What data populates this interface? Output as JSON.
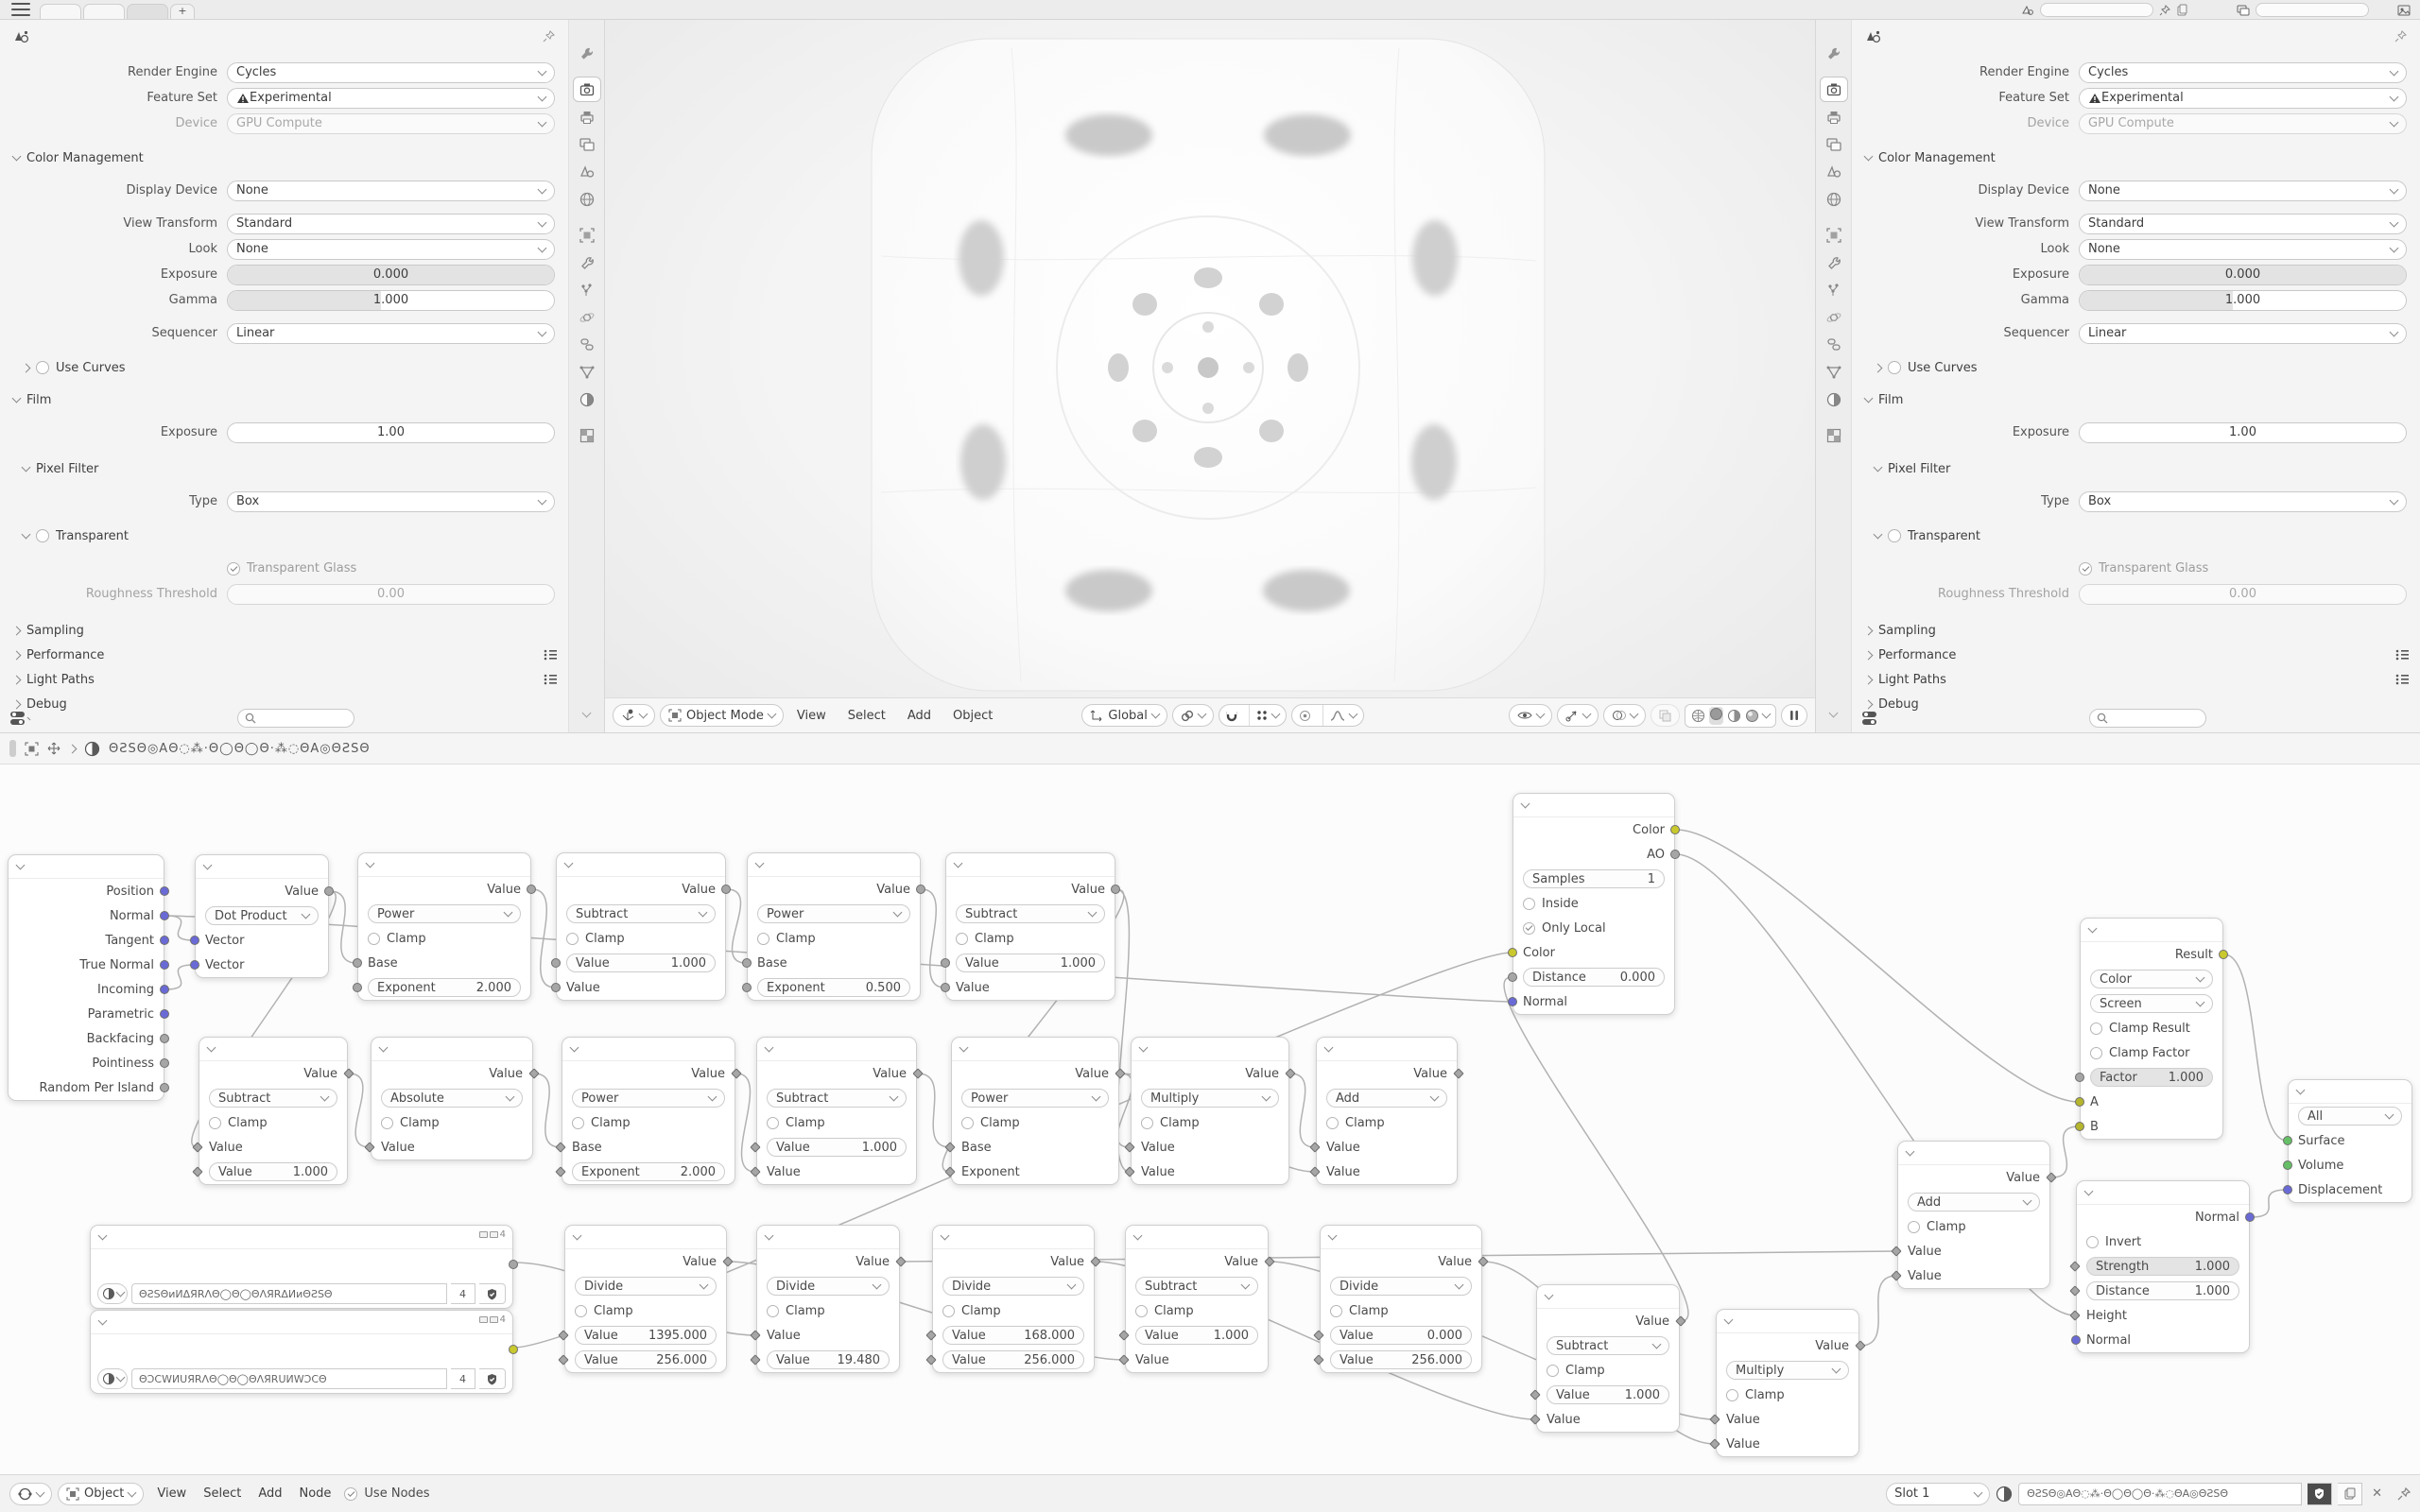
{
  "ui": {
    "topbar": {
      "new_tab": "+",
      "tab_count": 3
    },
    "prop_tabs": [
      "tool",
      "render",
      "output",
      "view-layer",
      "scene",
      "world",
      "object",
      "modifiers",
      "particles",
      "physics",
      "constraints",
      "data",
      "material",
      "texture"
    ],
    "active_tab": "render"
  },
  "props": {
    "render_engine": {
      "label": "Render Engine",
      "value": "Cycles"
    },
    "feature_set": {
      "label": "Feature Set",
      "value": "Experimental"
    },
    "device": {
      "label": "Device",
      "value": "GPU Compute"
    },
    "cm_title": "Color Management",
    "display_device": {
      "label": "Display Device",
      "value": "None"
    },
    "view_transform": {
      "label": "View Transform",
      "value": "Standard"
    },
    "look": {
      "label": "Look",
      "value": "None"
    },
    "exposure": {
      "label": "Exposure",
      "value": "0.000"
    },
    "gamma": {
      "label": "Gamma",
      "value": "1.000"
    },
    "sequencer": {
      "label": "Sequencer",
      "value": "Linear"
    },
    "use_curves": "Use Curves",
    "film_title": "Film",
    "film_exposure": {
      "label": "Exposure",
      "value": "1.00"
    },
    "pixel_filter_title": "Pixel Filter",
    "pf_type": {
      "label": "Type",
      "value": "Box"
    },
    "transparent_title": "Transparent",
    "transparent_glass": "Transparent Glass",
    "roughness": {
      "label": "Roughness Threshold",
      "value": "0.00"
    },
    "sampling": "Sampling",
    "performance": "Performance",
    "light_paths": "Light Paths",
    "debug": "Debug"
  },
  "viewport": {
    "mode": "Object Mode",
    "menus": [
      "View",
      "Select",
      "Add",
      "Object"
    ],
    "orientation": "Global"
  },
  "node_editor": {
    "material_name": "ΘƧSΘ◎AΘ◌⁂·Θ◯Θ◯Θ·⁂◌ΘA◎ΘƧSΘ",
    "footer": {
      "object": "Object",
      "menus": [
        "View",
        "Select",
        "Add",
        "Node"
      ],
      "use_nodes": "Use Nodes",
      "slot": "Slot 1",
      "material": "ΘƧSΘ◎AΘ◌⁂·Θ◯Θ◯Θ·⁂◌ΘA◎ΘƧSΘ"
    },
    "socket_colors": {
      "vec": "#6a6ad6",
      "gray": "#a6a6a6",
      "grayd": "#a6a6a6",
      "yellow": "#c9c92e",
      "olive": "#b5b52e",
      "green": "#66bf66"
    },
    "nodes": {
      "geometry": {
        "rows": [
          [
            "out",
            "Position",
            "vec"
          ],
          [
            "out",
            "Normal",
            "vec"
          ],
          [
            "out",
            "Tangent",
            "vec"
          ],
          [
            "out",
            "True Normal",
            "vec"
          ],
          [
            "out",
            "Incoming",
            "vec"
          ],
          [
            "out",
            "Parametric",
            "vec"
          ],
          [
            "out",
            "Backfacing",
            "gray"
          ],
          [
            "out",
            "Pointiness",
            "gray"
          ],
          [
            "out",
            "Random Per Island",
            "gray"
          ]
        ]
      },
      "dot": {
        "rows": [
          [
            "out",
            "Value",
            "gray"
          ],
          [
            "select",
            "Dot Product"
          ],
          [
            "in",
            "Vector",
            "vec"
          ],
          [
            "in",
            "Vector",
            "vec"
          ]
        ]
      },
      "pow1": {
        "rows": [
          [
            "out",
            "Value",
            "gray"
          ],
          [
            "select",
            "Power"
          ],
          [
            "check",
            "Clamp",
            0
          ],
          [
            "in",
            "Base",
            "gray"
          ],
          [
            "field",
            "Exponent",
            "2.000",
            "gray"
          ]
        ]
      },
      "sub1": {
        "rows": [
          [
            "out",
            "Value",
            "gray"
          ],
          [
            "select",
            "Subtract"
          ],
          [
            "check",
            "Clamp",
            0
          ],
          [
            "field",
            "Value",
            "1.000",
            "gray"
          ],
          [
            "in",
            "Value",
            "gray"
          ]
        ]
      },
      "pow2": {
        "rows": [
          [
            "out",
            "Value",
            "gray"
          ],
          [
            "select",
            "Power"
          ],
          [
            "check",
            "Clamp",
            0
          ],
          [
            "in",
            "Base",
            "gray"
          ],
          [
            "field",
            "Exponent",
            "0.500",
            "gray"
          ]
        ]
      },
      "sub2": {
        "rows": [
          [
            "out",
            "Value",
            "gray"
          ],
          [
            "select",
            "Subtract"
          ],
          [
            "check",
            "Clamp",
            0
          ],
          [
            "field",
            "Value",
            "1.000",
            "gray"
          ],
          [
            "in",
            "Value",
            "gray"
          ]
        ]
      },
      "sub3": {
        "rows": [
          [
            "out",
            "Value",
            "grayd"
          ],
          [
            "select",
            "Subtract"
          ],
          [
            "check",
            "Clamp",
            0
          ],
          [
            "in",
            "Value",
            "grayd"
          ],
          [
            "field",
            "Value",
            "1.000",
            "grayd"
          ]
        ]
      },
      "abs1": {
        "rows": [
          [
            "out",
            "Value",
            "grayd"
          ],
          [
            "select",
            "Absolute"
          ],
          [
            "check",
            "Clamp",
            0
          ],
          [
            "in",
            "Value",
            "grayd"
          ]
        ]
      },
      "pow3": {
        "rows": [
          [
            "out",
            "Value",
            "grayd"
          ],
          [
            "select",
            "Power"
          ],
          [
            "check",
            "Clamp",
            0
          ],
          [
            "in",
            "Base",
            "grayd"
          ],
          [
            "field",
            "Exponent",
            "2.000",
            "grayd"
          ]
        ]
      },
      "sub4": {
        "rows": [
          [
            "out",
            "Value",
            "grayd"
          ],
          [
            "select",
            "Subtract"
          ],
          [
            "check",
            "Clamp",
            0
          ],
          [
            "field",
            "Value",
            "1.000",
            "grayd"
          ],
          [
            "in",
            "Value",
            "grayd"
          ]
        ]
      },
      "pow4": {
        "rows": [
          [
            "out",
            "Value",
            "grayd"
          ],
          [
            "select",
            "Power"
          ],
          [
            "check",
            "Clamp",
            0
          ],
          [
            "in",
            "Base",
            "grayd"
          ],
          [
            "in",
            "Exponent",
            "grayd"
          ]
        ]
      },
      "mult1": {
        "rows": [
          [
            "out",
            "Value",
            "grayd"
          ],
          [
            "select",
            "Multiply"
          ],
          [
            "check",
            "Clamp",
            0
          ],
          [
            "in",
            "Value",
            "grayd"
          ],
          [
            "in",
            "Value",
            "grayd"
          ]
        ]
      },
      "add1": {
        "rows": [
          [
            "out",
            "Value",
            "grayd"
          ],
          [
            "select",
            "Add"
          ],
          [
            "check",
            "Clamp",
            0
          ],
          [
            "in",
            "Value",
            "grayd"
          ],
          [
            "in",
            "Value",
            "grayd"
          ]
        ]
      },
      "img1": {
        "type": "image",
        "name": "ΘƧSΘͷͶΔЯRΛΘ◯Θ◯ΘΛЯRΔͶͷΘƧSΘ",
        "count": "4",
        "out_color": "gray"
      },
      "img2": {
        "type": "image",
        "name": "ΘƆCWͶUЯRΛΘ◯Θ◯ΘΛЯRUͶWƆCΘ",
        "count": "4",
        "out_color": "yellow"
      },
      "div1": {
        "rows": [
          [
            "out",
            "Value",
            "grayd"
          ],
          [
            "select",
            "Divide"
          ],
          [
            "check",
            "Clamp",
            0
          ],
          [
            "field",
            "Value",
            "1395.000",
            "grayd"
          ],
          [
            "field",
            "Value",
            "256.000",
            "grayd"
          ]
        ]
      },
      "div2": {
        "rows": [
          [
            "out",
            "Value",
            "grayd"
          ],
          [
            "select",
            "Divide"
          ],
          [
            "check",
            "Clamp",
            0
          ],
          [
            "in",
            "Value",
            "grayd"
          ],
          [
            "field",
            "Value",
            "19.480",
            "grayd"
          ]
        ]
      },
      "div3": {
        "rows": [
          [
            "out",
            "Value",
            "grayd"
          ],
          [
            "select",
            "Divide"
          ],
          [
            "check",
            "Clamp",
            0
          ],
          [
            "field",
            "Value",
            "168.000",
            "grayd"
          ],
          [
            "field",
            "Value",
            "256.000",
            "grayd"
          ]
        ]
      },
      "sub5": {
        "rows": [
          [
            "out",
            "Value",
            "grayd"
          ],
          [
            "select",
            "Subtract"
          ],
          [
            "check",
            "Clamp",
            0
          ],
          [
            "field",
            "Value",
            "1.000",
            "grayd"
          ],
          [
            "in",
            "Value",
            "grayd"
          ]
        ]
      },
      "div4": {
        "rows": [
          [
            "out",
            "Value",
            "grayd"
          ],
          [
            "select",
            "Divide"
          ],
          [
            "check",
            "Clamp",
            0
          ],
          [
            "field",
            "Value",
            "0.000",
            "grayd"
          ],
          [
            "field",
            "Value",
            "256.000",
            "grayd"
          ]
        ]
      },
      "sub6": {
        "rows": [
          [
            "out",
            "Value",
            "grayd"
          ],
          [
            "select",
            "Subtract"
          ],
          [
            "check",
            "Clamp",
            0
          ],
          [
            "field",
            "Value",
            "1.000",
            "grayd"
          ],
          [
            "in",
            "Value",
            "grayd"
          ]
        ]
      },
      "mult2": {
        "rows": [
          [
            "out",
            "Value",
            "grayd"
          ],
          [
            "select",
            "Multiply"
          ],
          [
            "check",
            "Clamp",
            0
          ],
          [
            "in",
            "Value",
            "grayd"
          ],
          [
            "in",
            "Value",
            "grayd"
          ]
        ]
      },
      "addc": {
        "rows": [
          [
            "out",
            "Value",
            "grayd"
          ],
          [
            "select",
            "Add"
          ],
          [
            "check",
            "Clamp",
            0
          ],
          [
            "in",
            "Value",
            "grayd"
          ],
          [
            "in",
            "Value",
            "grayd"
          ]
        ]
      },
      "ao": {
        "rows": [
          [
            "out",
            "Color",
            "yellow"
          ],
          [
            "out",
            "AO",
            "gray"
          ],
          [
            "nfield",
            "Samples",
            "1"
          ],
          [
            "check",
            "Inside",
            0
          ],
          [
            "check",
            "Only Local",
            1
          ],
          [
            "in",
            "Color",
            "yellow"
          ],
          [
            "field",
            "Distance",
            "0.000",
            "gray"
          ],
          [
            "in",
            "Normal",
            "vec"
          ]
        ]
      },
      "mix": {
        "rows": [
          [
            "out",
            "Result",
            "yellow"
          ],
          [
            "select",
            "Color"
          ],
          [
            "select",
            "Screen"
          ],
          [
            "check",
            "Clamp Result",
            0
          ],
          [
            "check",
            "Clamp Factor",
            0
          ],
          [
            "fieldfill",
            "Factor",
            "1.000",
            "gray"
          ],
          [
            "in",
            "A",
            "olive"
          ],
          [
            "in",
            "B",
            "olive"
          ]
        ]
      },
      "bump": {
        "rows": [
          [
            "out",
            "Normal",
            "vec"
          ],
          [
            "check",
            "Invert",
            0
          ],
          [
            "fieldfill",
            "Strength",
            "1.000",
            "grayd"
          ],
          [
            "field",
            "Distance",
            "1.000",
            "grayd"
          ],
          [
            "in",
            "Height",
            "grayd"
          ],
          [
            "in",
            "Normal",
            "vec"
          ]
        ]
      },
      "outn": {
        "rows": [
          [
            "select",
            "All"
          ],
          [
            "in",
            "Surface",
            "green"
          ],
          [
            "in",
            "Volume",
            "green"
          ],
          [
            "in",
            "Displacement",
            "vec"
          ]
        ]
      }
    }
  }
}
